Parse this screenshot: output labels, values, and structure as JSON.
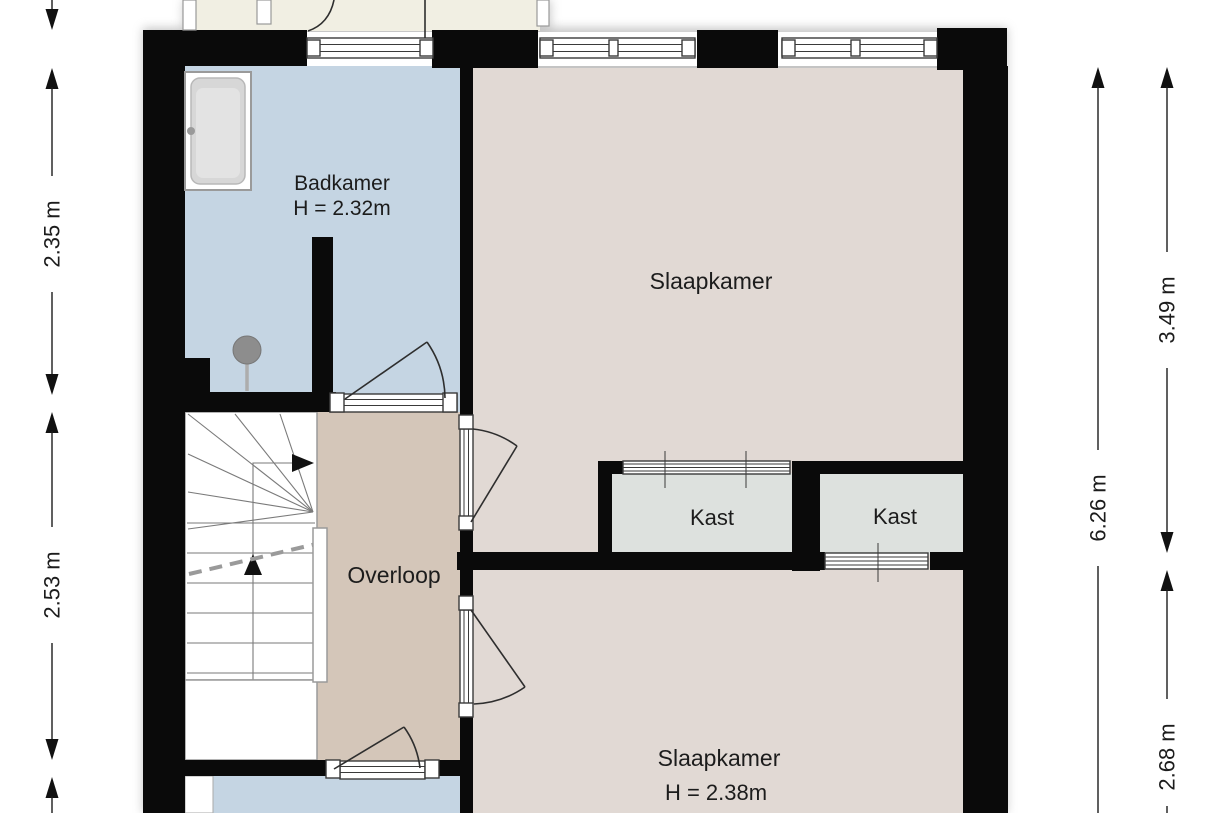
{
  "plan_title": "floorplan-second-floor",
  "rooms": {
    "badkamer": {
      "label": "Badkamer",
      "height": "H = 2.32m"
    },
    "slaapkamer_top": {
      "label": "Slaapkamer"
    },
    "overloop": {
      "label": "Overloop"
    },
    "kast_left": {
      "label": "Kast"
    },
    "kast_right": {
      "label": "Kast"
    },
    "slaapkamer_bottom": {
      "label": "Slaapkamer",
      "height": "H = 2.38m"
    }
  },
  "dimensions": {
    "left_upper": "2.35 m",
    "left_lower": "2.53 m",
    "right_outer_upper": "3.49 m",
    "right_inner": "6.26 m",
    "right_outer_lower": "2.68 m"
  },
  "colors": {
    "wall": "#0a0a0a",
    "badkamer": "#c5d5e3",
    "slaapkamer": "#e1d9d4",
    "overloop": "#d4c6b9",
    "kast": "#dde1de",
    "upper_room": "#f1efe3",
    "fixture": "#8d8d8d",
    "text": "#1c1c1c"
  }
}
